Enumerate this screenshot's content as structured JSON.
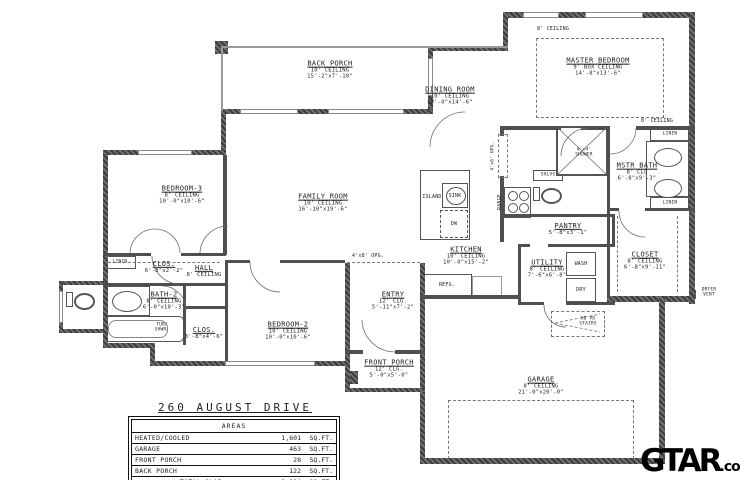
{
  "plan": {
    "address": "260  AUGUST  DRIVE",
    "rooms": [
      {
        "id": "back-porch",
        "name": "BACK PORCH",
        "ceiling": "10' CEILING",
        "dims": "15'-2\"x7'-10\""
      },
      {
        "id": "master-bedroom",
        "name": "MASTER BEDROOM",
        "ceiling": "9' BOX CEILING",
        "dims": "14'-8\"x13'-6\""
      },
      {
        "id": "dining-room",
        "name": "DINING ROOM",
        "ceiling": "10' CEILING",
        "dims": "10'-0\"x14'-6\""
      },
      {
        "id": "family-room",
        "name": "FAMILY ROOM",
        "ceiling": "10' CEILING",
        "dims": "16'-10\"x19'-6\""
      },
      {
        "id": "kitchen",
        "name": "KITCHEN",
        "ceiling": "10' CEILING",
        "dims": "10'-0\"x15'-2\""
      },
      {
        "id": "bedroom-3",
        "name": "BEDROOM-3",
        "ceiling": "8' CEILING",
        "dims": "10'-0\"x10'-6\""
      },
      {
        "id": "hall",
        "name": "HALL",
        "ceiling": "8' CEILING",
        "dims": ""
      },
      {
        "id": "bath-2",
        "name": "BATH-2",
        "ceiling": "8' CEILING",
        "dims": "6'-0\"x10'-3\""
      },
      {
        "id": "bedroom-2",
        "name": "BEDROOM-2",
        "ceiling": "10' CEILING",
        "dims": "10'-0\"x10'-6\""
      },
      {
        "id": "entry",
        "name": "ENTRY",
        "ceiling": "12' CLG.",
        "dims": "5'-11\"x7'-2\""
      },
      {
        "id": "front-porch",
        "name": "FRONT PORCH",
        "ceiling": "12' CLG.",
        "dims": "5'-0\"x5'-0\""
      },
      {
        "id": "garage",
        "name": "GARAGE",
        "ceiling": "8' CEILING",
        "dims": "21'-0\"x20'-0\""
      },
      {
        "id": "mstr-bath",
        "name": "MSTR BATH",
        "ceiling": "8' CLG",
        "dims": "6'-8\"x9'-3\""
      },
      {
        "id": "master-closet",
        "name": "CLOSET",
        "ceiling": "8' CEILING",
        "dims": "6'-8\"x9'-11\""
      },
      {
        "id": "pantry",
        "name": "PANTRY",
        "ceiling": "",
        "dims": "5'-8\"x3'-1\""
      },
      {
        "id": "utility",
        "name": "UTILITY",
        "ceiling": "8' CEILING",
        "dims": "7'-6\"x6'-8\""
      },
      {
        "id": "closet-bed3",
        "name": "CLOS.",
        "ceiling": "",
        "dims": "6'-8\"x2'-2\""
      },
      {
        "id": "closet-hall",
        "name": "CLOS.",
        "ceiling": "",
        "dims": "3'-8\"x4'-6\""
      }
    ],
    "fixtures": {
      "island": "ISLAND",
      "sink": "SINK",
      "dishwasher": "DW",
      "refrigerator": "REFG.",
      "range": "RANGE",
      "shelves": "SHLVS",
      "shower": "SHOWER",
      "shower_size": "4'x4'",
      "washer": "WASH",
      "dryer": "DRY",
      "linen": "LINEN",
      "tub_line1": "TUB/",
      "tub_line2": "SHWR.",
      "stairs_line1": "HD PD",
      "stairs_line2": "STAIRS",
      "dryer_vent_line1": "DRYER",
      "dryer_vent_line2": "VENT"
    },
    "annotations": {
      "ceiling8_left": "8' CEILING",
      "ceiling8_right": "8' CEILING",
      "opening_entry": "4'x8' OPG.",
      "opening_master": "4'x8' OPG."
    },
    "areas_table": {
      "header": "AREAS",
      "unit": "SQ.FT.",
      "rows": [
        {
          "label": "HEATED/COOLED",
          "value": "1,601"
        },
        {
          "label": "GARAGE",
          "value": "463"
        },
        {
          "label": "FRONT  PORCH",
          "value": "28"
        },
        {
          "label": "BACK  PORCH",
          "value": "122"
        },
        {
          "label": "TOTAL  SLAB",
          "value": "2,214"
        }
      ]
    },
    "watermark": {
      "name": "GTAR",
      "tld": ".com"
    },
    "colors": {
      "wall": "#4f4f4f",
      "thin_line": "#9a9a9a",
      "text": "#1f1f1f",
      "background": "#ffffff"
    }
  }
}
